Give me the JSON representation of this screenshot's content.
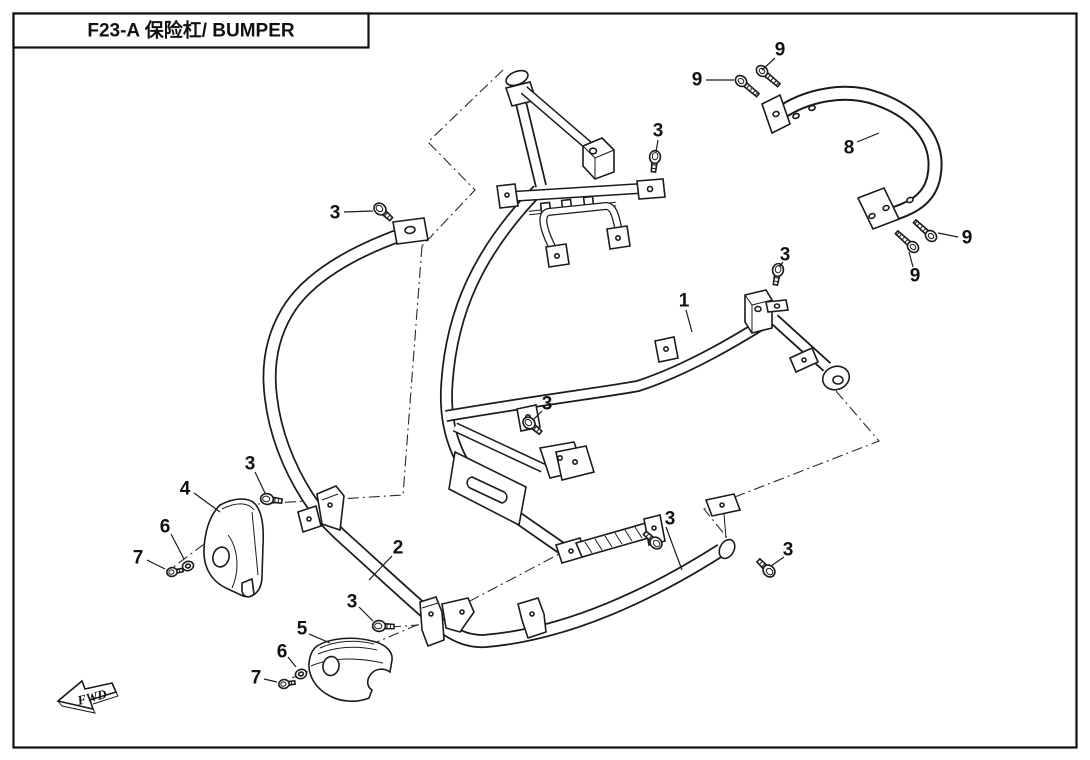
{
  "window": {
    "width": 1090,
    "height": 760
  },
  "header": {
    "title": "F23-A 保险杠/ BUMPER"
  },
  "diagram": {
    "fwd_label": "FWD",
    "line_color": "#1b1b1b",
    "background_color": "#ffffff",
    "callouts": [
      {
        "label": "3",
        "ref": "flange-bolt",
        "x": 335,
        "y": 213,
        "leader": [
          344,
          212,
          373,
          211
        ]
      },
      {
        "label": "9",
        "ref": "socket-bolt",
        "x": 780,
        "y": 50,
        "leader": [
          775,
          58,
          762,
          70
        ]
      },
      {
        "label": "9",
        "ref": "socket-bolt",
        "x": 697,
        "y": 80,
        "leader": [
          706,
          80,
          734,
          80
        ]
      },
      {
        "label": "8",
        "ref": "rear-bumper-bar",
        "x": 849,
        "y": 148,
        "leader": [
          857,
          142,
          879,
          133
        ]
      },
      {
        "label": "3",
        "ref": "flange-bolt",
        "x": 658,
        "y": 131,
        "leader": [
          658,
          140,
          656,
          152
        ]
      },
      {
        "label": "9",
        "ref": "socket-bolt",
        "x": 967,
        "y": 238,
        "leader": [
          958,
          237,
          938,
          233
        ]
      },
      {
        "label": "9",
        "ref": "socket-bolt",
        "x": 915,
        "y": 276,
        "leader": [
          913,
          267,
          909,
          252
        ]
      },
      {
        "label": "3",
        "ref": "flange-bolt",
        "x": 785,
        "y": 255,
        "leader": [
          783,
          262,
          779,
          267
        ]
      },
      {
        "label": "1",
        "ref": "main-bumper-frame",
        "x": 684,
        "y": 301,
        "leader": [
          686,
          310,
          692,
          332
        ]
      },
      {
        "label": "3",
        "ref": "flange-bolt",
        "x": 547,
        "y": 404,
        "leader": [
          542,
          411,
          533,
          420
        ]
      },
      {
        "label": "4",
        "ref": "left-cover",
        "x": 185,
        "y": 489,
        "leader": [
          194,
          493,
          220,
          512
        ]
      },
      {
        "label": "3",
        "ref": "flange-bolt",
        "x": 250,
        "y": 464,
        "leader": [
          255,
          472,
          265,
          493
        ]
      },
      {
        "label": "6",
        "ref": "washer",
        "x": 165,
        "y": 527,
        "leader": [
          171,
          534,
          184,
          559
        ]
      },
      {
        "label": "7",
        "ref": "hex-bolt",
        "x": 138,
        "y": 558,
        "leader": [
          147,
          560,
          165,
          569
        ]
      },
      {
        "label": "2",
        "ref": "lower-bumper-tube",
        "x": 398,
        "y": 548,
        "leader": [
          392,
          556,
          369,
          580
        ]
      },
      {
        "label": "3",
        "ref": "flange-bolt",
        "x": 670,
        "y": 519,
        "leader": [
          666,
          527,
          682,
          570
        ]
      },
      {
        "label": "3",
        "ref": "flange-bolt",
        "x": 788,
        "y": 550,
        "leader": [
          784,
          557,
          771,
          566
        ]
      },
      {
        "label": "3",
        "ref": "flange-bolt",
        "x": 352,
        "y": 602,
        "leader": [
          359,
          607,
          373,
          621
        ]
      },
      {
        "label": "5",
        "ref": "right-cover",
        "x": 302,
        "y": 629,
        "leader": [
          309,
          634,
          330,
          643
        ]
      },
      {
        "label": "6",
        "ref": "washer",
        "x": 282,
        "y": 652,
        "leader": [
          288,
          657,
          296,
          667
        ]
      },
      {
        "label": "7",
        "ref": "hex-bolt",
        "x": 256,
        "y": 678,
        "leader": [
          264,
          679,
          277,
          682
        ]
      }
    ]
  }
}
